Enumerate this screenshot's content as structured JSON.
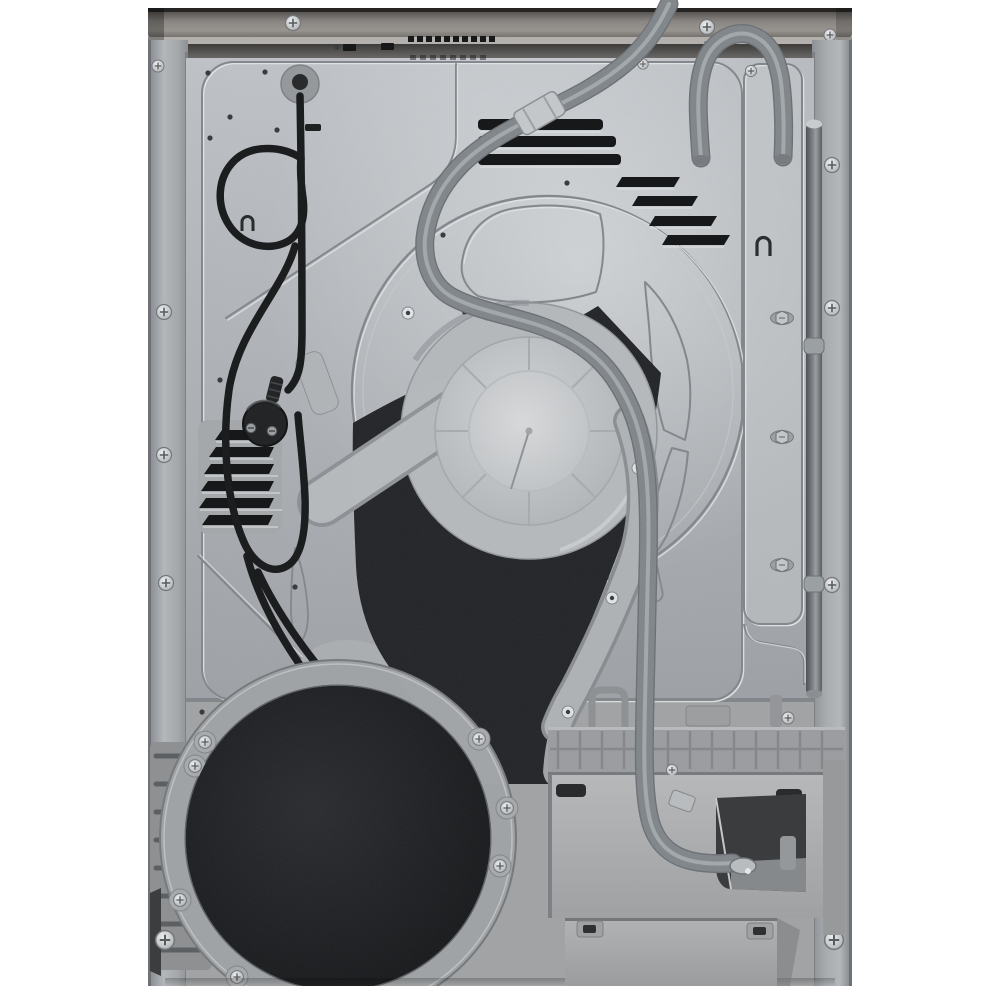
{
  "scene": {
    "title": "rear view of a freestanding tumble dryer, product photo on white background",
    "background": "#ffffff"
  },
  "colors": {
    "worktop": "#6f6c69",
    "panel": "#b8bcc0",
    "panel_highlight": "#dde0e2",
    "flange": "#9fa3a7",
    "groove_dark": "#84888c",
    "groove_light": "#e1e4e6",
    "vent": "#17181a",
    "cord": "#1c1d1f",
    "plug": "#242527",
    "hose": "#989da1",
    "hose_rib": "#70757a",
    "hose_sleeve": "#c4c7c9",
    "insulation": "#212226",
    "disc": "#1b1c1e",
    "duct": "#b4b8bb",
    "hub": "#c6c9cc",
    "ring": "#a0a3a5",
    "base": "#a1a3a5",
    "module": "#9b9da0",
    "module_face": "#adafb1",
    "recess": "#3a3c3e",
    "rail": "#6e7276",
    "screw": "#d9dbdd"
  },
  "parts": [
    "worktop edge panel",
    "rear sheet-metal panel",
    "left side flange",
    "right side flange",
    "power cord with UK plug",
    "cord entry grommet",
    "drain hose",
    "hose storage loop",
    "ventilation louvers",
    "stamped drum circle",
    "drum bearing hub",
    "air duct rim",
    "black insulation pad",
    "blower cover disc",
    "mounting ring",
    "condenser pump module",
    "drain hose connection recess",
    "service flap"
  ]
}
